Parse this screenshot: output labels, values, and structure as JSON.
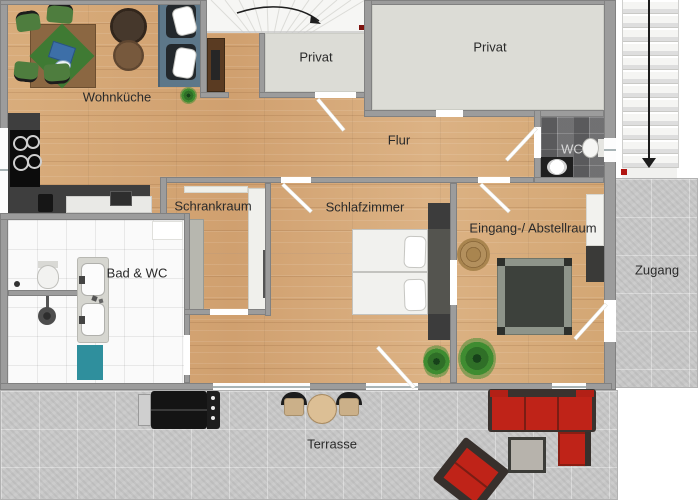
{
  "plan_title": "apartment-floor-plan",
  "rooms": {
    "wohnkueche": {
      "label": "Wohnküche"
    },
    "privat_top": {
      "label": "Privat"
    },
    "privat_right": {
      "label": "Privat"
    },
    "flur": {
      "label": "Flur"
    },
    "wc": {
      "label": "WC"
    },
    "schrankraum": {
      "label": "Schrankraum"
    },
    "schlafzimmer": {
      "label": "Schlafzimmer"
    },
    "bad_wc": {
      "label": "Bad & WC"
    },
    "eingang": {
      "label": "Eingang-/ Abstellraum"
    },
    "zugang": {
      "label": "Zugang"
    },
    "terrasse": {
      "label": "Terrasse"
    }
  },
  "icons": {
    "exterior_stairs_arrow": "stairs-down-arrow",
    "interior_stairs_arrow": "stairs-turn-arrow"
  },
  "colors": {
    "wood_floor": "#d6a877",
    "wall": "#9c9c9c",
    "privat_floor": "#dcdcd6",
    "concrete": "#c7c7c7",
    "wc_tile": "#69696b",
    "bath_tile": "#fafafa",
    "sofa_blue": "#5d7789",
    "chair_green": "#4e7d3e",
    "furniture_red": "#bf2318",
    "teal_mat": "#2f8f9d",
    "marker_red": "#a01010"
  }
}
